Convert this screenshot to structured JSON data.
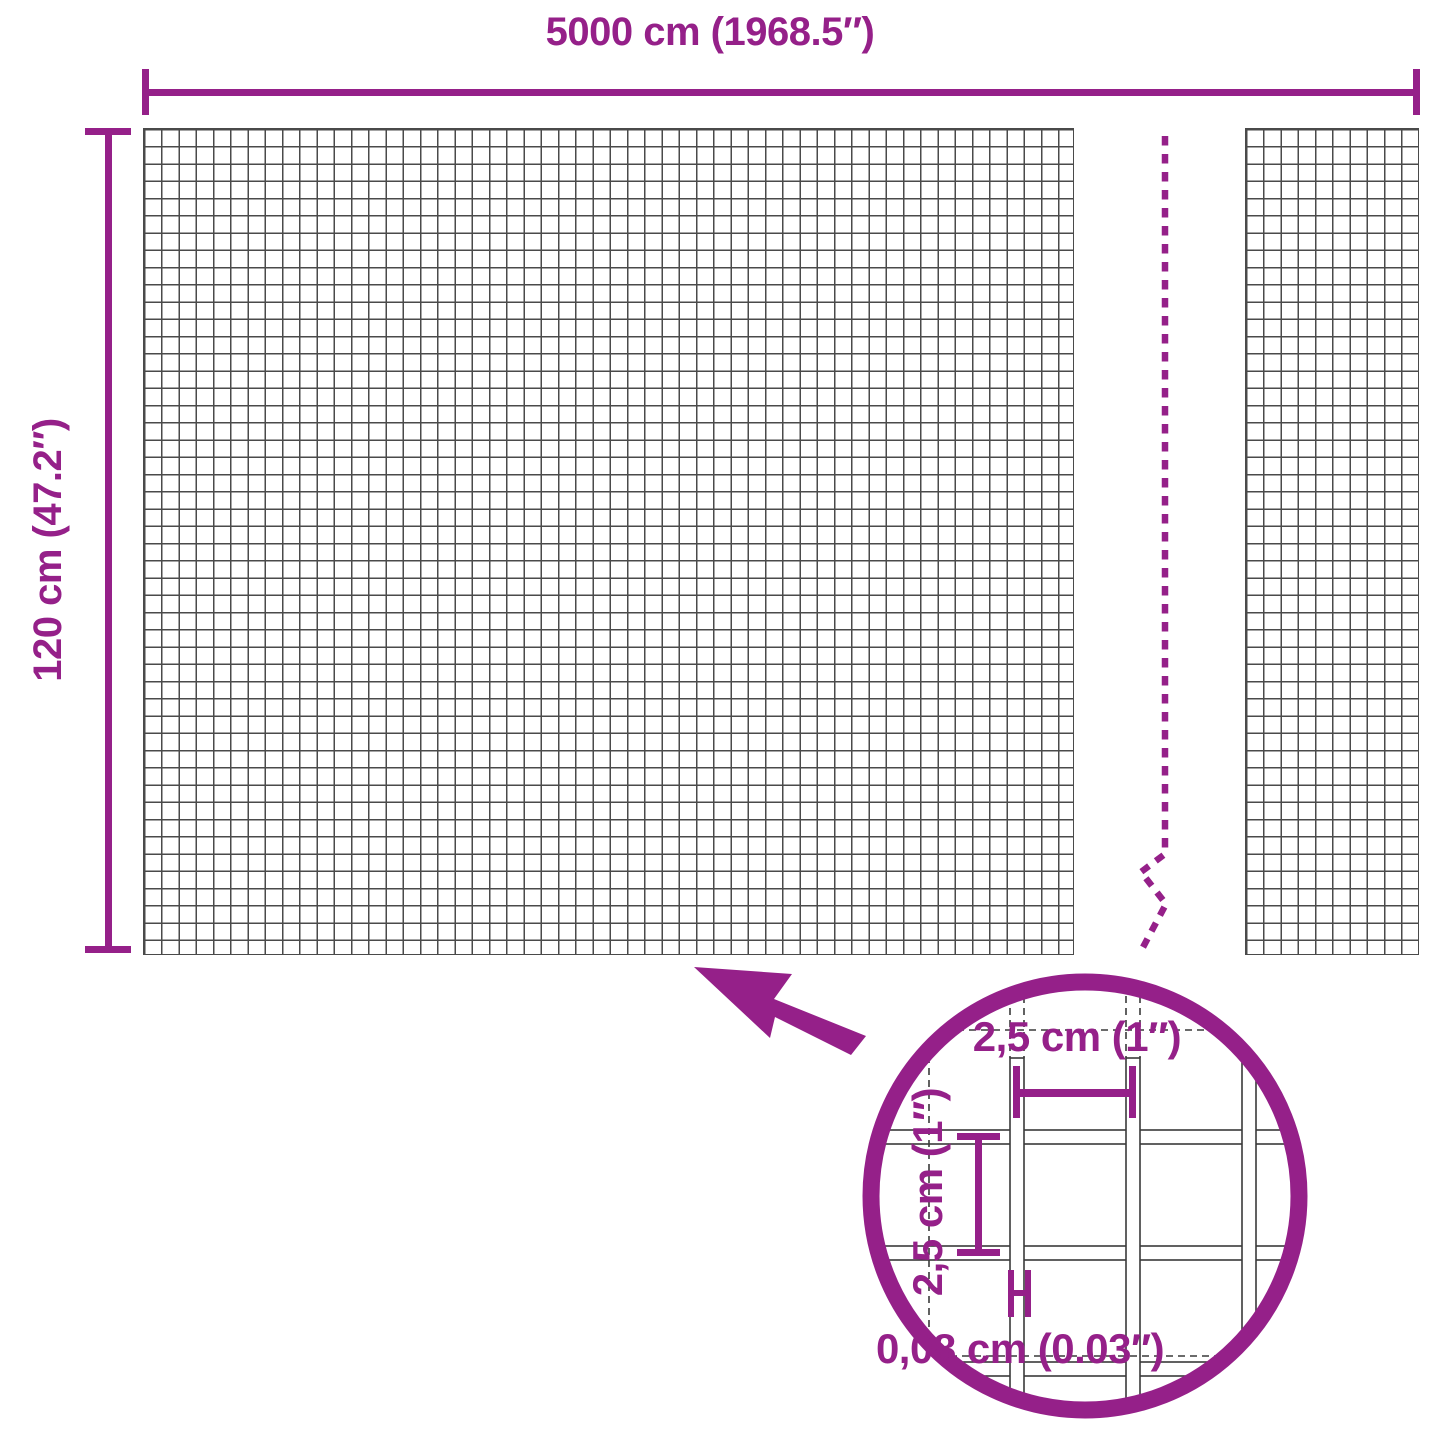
{
  "colors": {
    "accent": "#952089",
    "mesh-line": "#4a4a4a",
    "wire-outline": "#3a3a3a",
    "background": "#ffffff"
  },
  "outer_dimensions": {
    "width_label": "5000 cm (1968.5″)",
    "height_label": "120 cm (47.2″)"
  },
  "detail_view": {
    "mesh_opening_width_label": "2,5 cm (1″)",
    "mesh_opening_height_label": "2,5 cm (1″)",
    "wire_thickness_label": "0,08 cm (0.03″)"
  },
  "icons": {
    "zoom_arrow": "arrow pointing from magnifier circle to mesh",
    "break_line": "dashed vertical break / continuation line",
    "magnifier_circle": "detail zoom circle"
  }
}
